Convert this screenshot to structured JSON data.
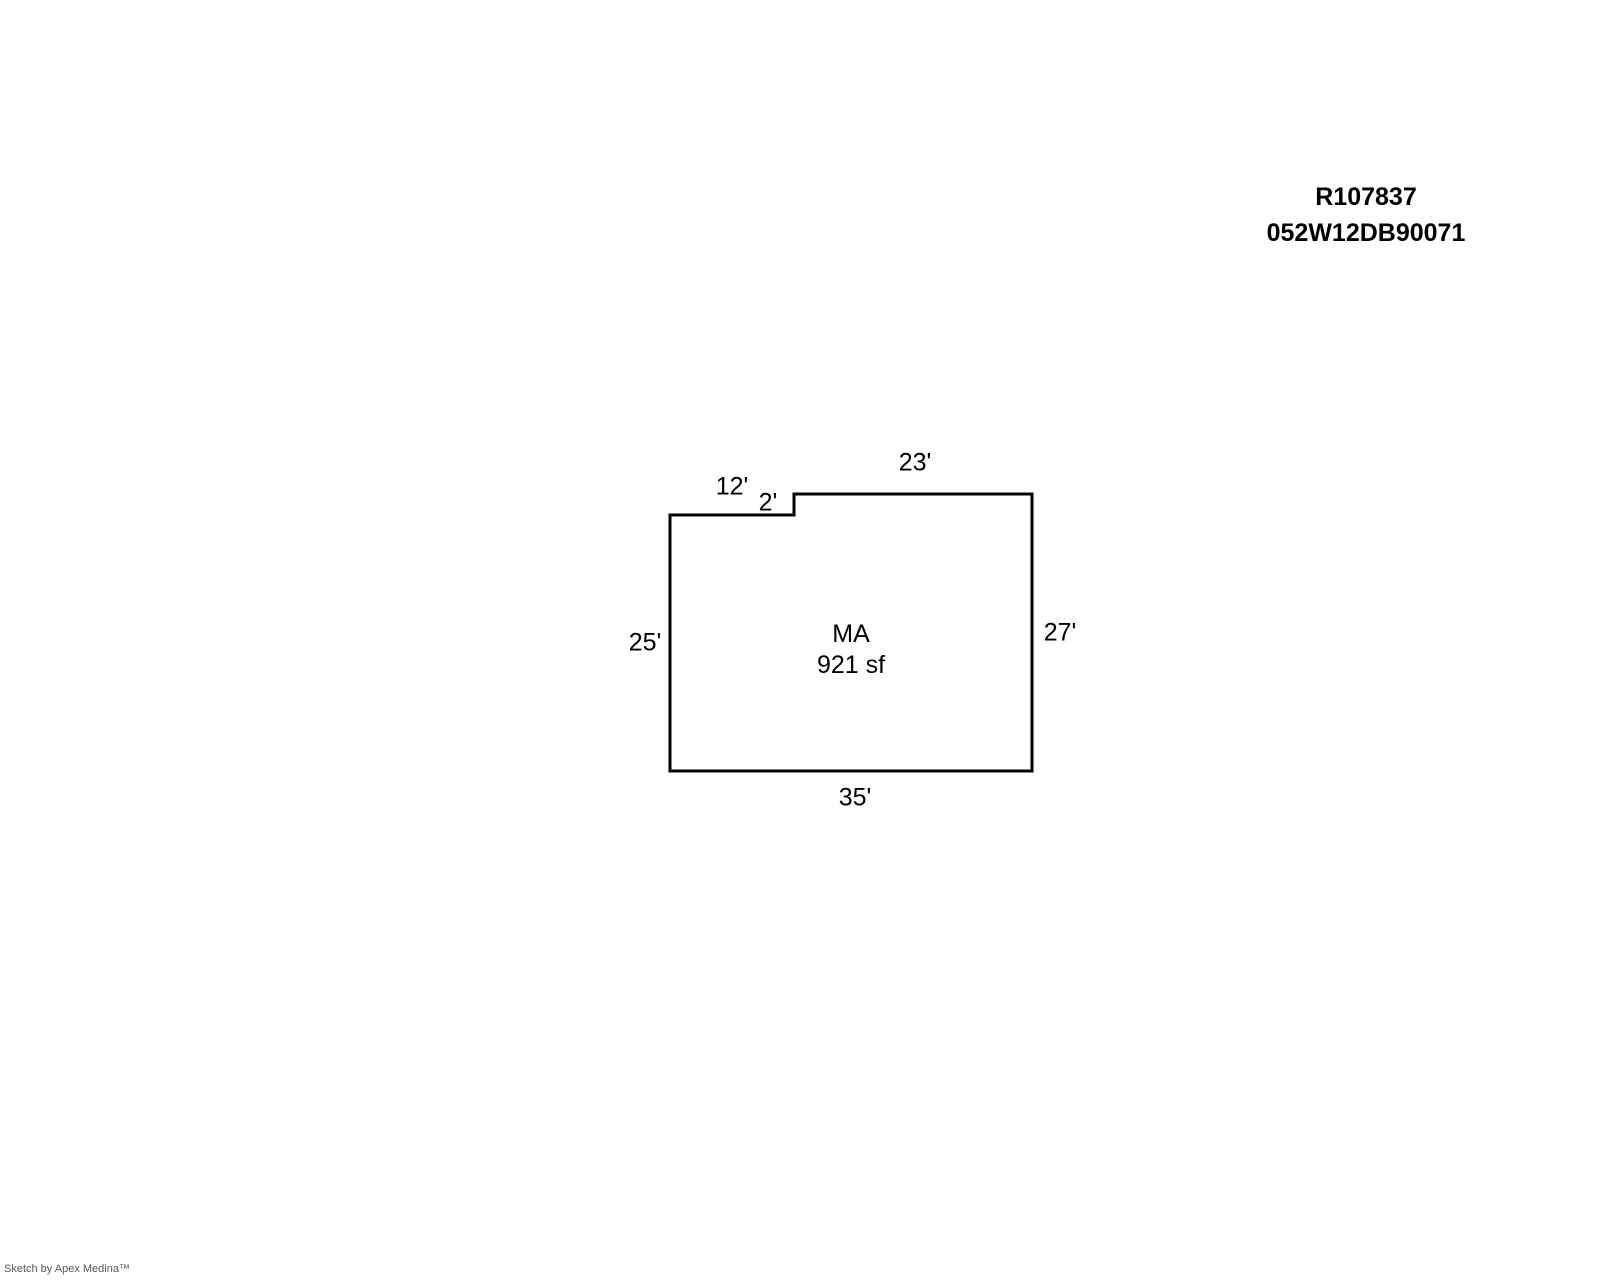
{
  "header": {
    "record_id": "R107837",
    "parcel_id": "052W12DB90071"
  },
  "sketch": {
    "room": {
      "name": "MA",
      "area": "921 sf",
      "area_sf": 921
    },
    "dimensions": [
      {
        "side": "top-left",
        "label": "12'",
        "feet": 12
      },
      {
        "side": "top-notch",
        "label": "2'",
        "feet": 2
      },
      {
        "side": "top-right",
        "label": "23'",
        "feet": 23
      },
      {
        "side": "left",
        "label": "25'",
        "feet": 25
      },
      {
        "side": "right",
        "label": "27'",
        "feet": 27
      },
      {
        "side": "bottom",
        "label": "35'",
        "feet": 35
      }
    ],
    "outline_color": "#000000",
    "background_color": "#ffffff"
  },
  "footer": {
    "credit": "Sketch by Apex Medina™",
    "color": "#595959"
  }
}
